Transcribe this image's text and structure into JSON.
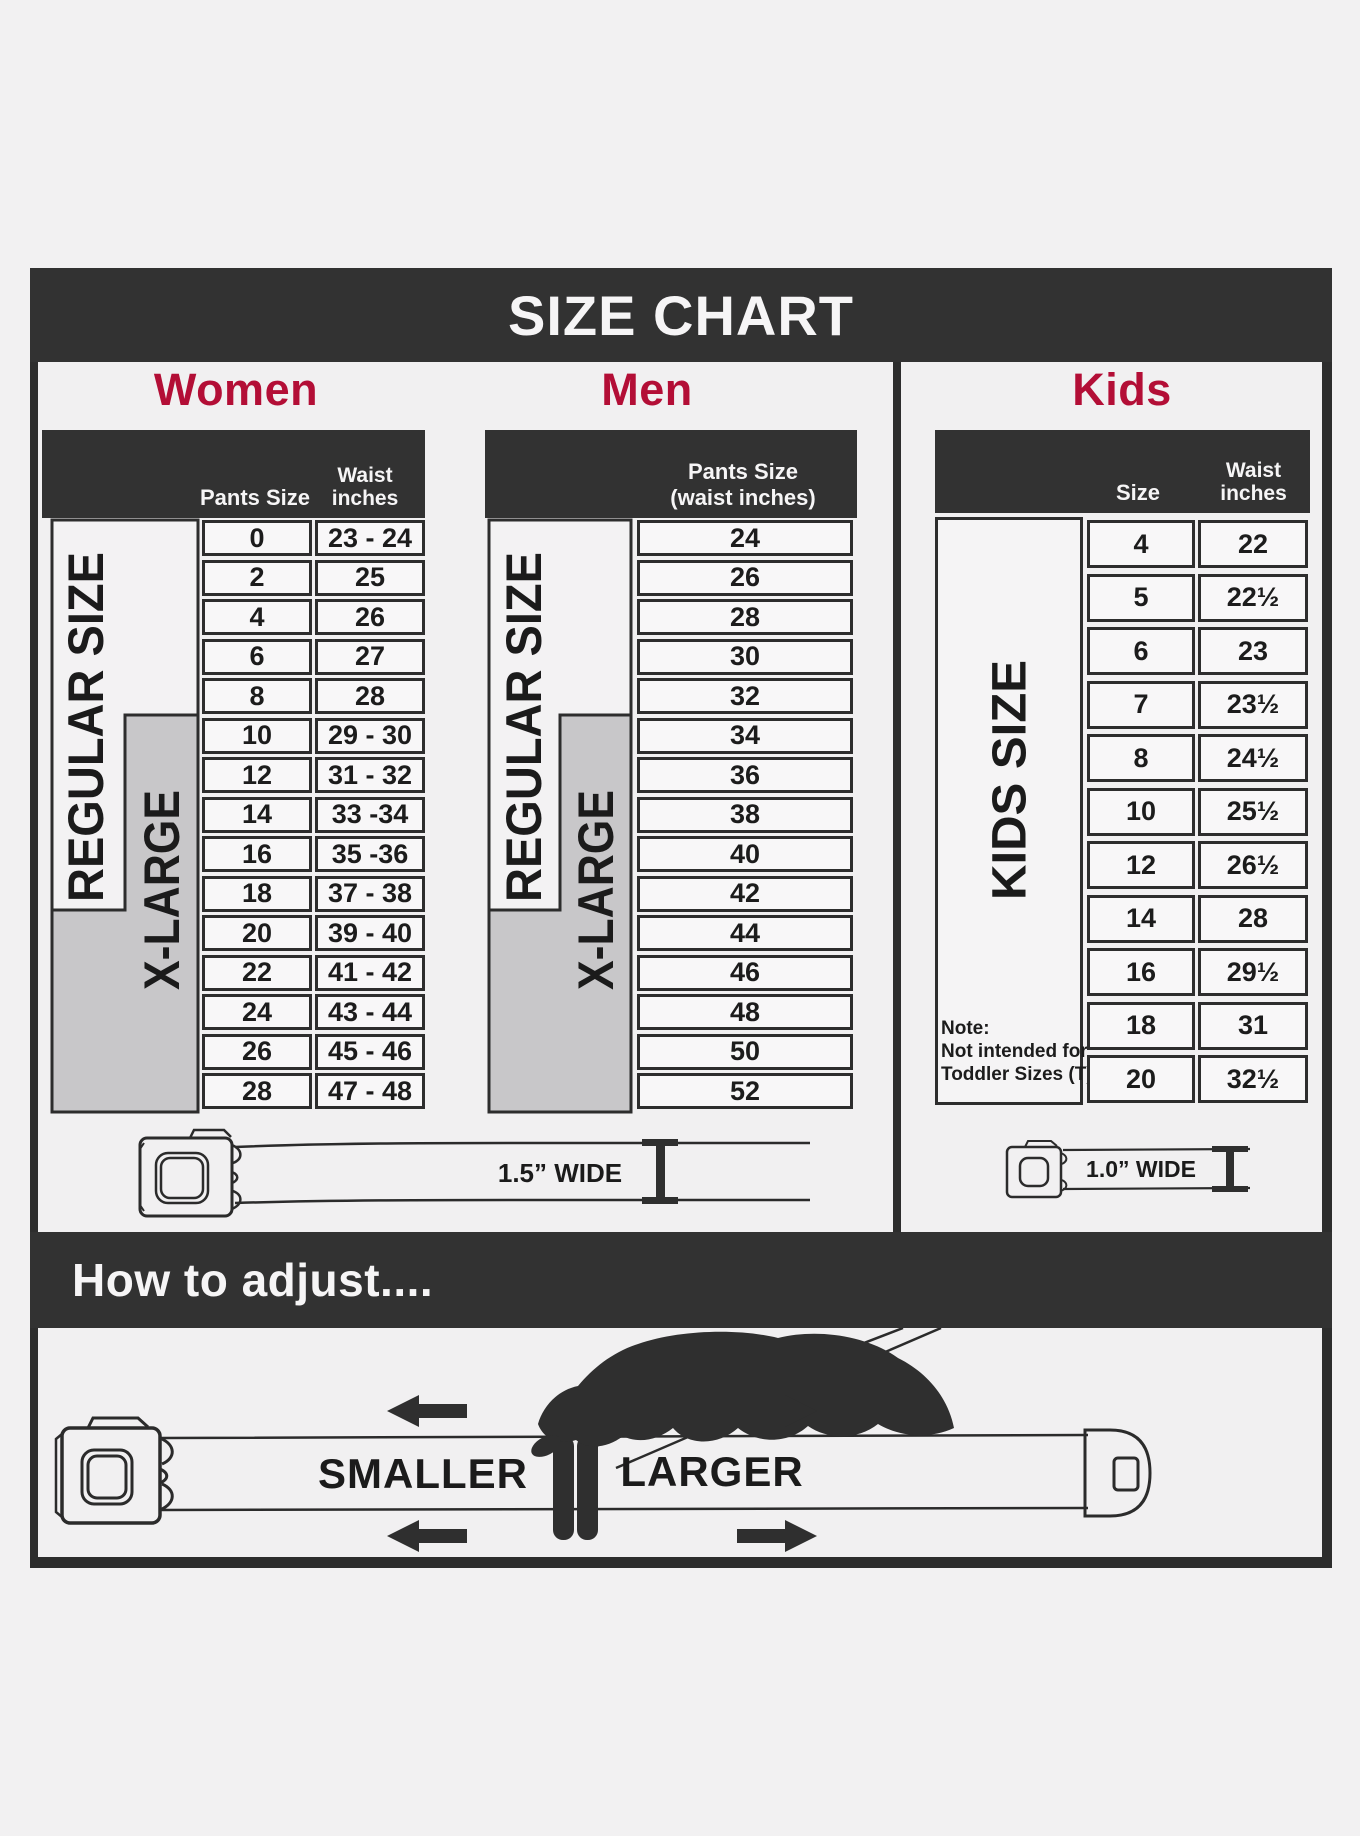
{
  "title": "SIZE CHART",
  "colors": {
    "accent_red": "#b30e36",
    "bar_dark": "#323232",
    "xlarge_gray": "#c8c7c9"
  },
  "women": {
    "heading": "Women",
    "col1_header": "Pants Size",
    "col2_header_line1": "Waist",
    "col2_header_line2": "inches",
    "label_regular": "REGULAR SIZE",
    "label_xlarge": "X-LARGE",
    "rows": [
      {
        "size": "0",
        "waist": "23 - 24"
      },
      {
        "size": "2",
        "waist": "25"
      },
      {
        "size": "4",
        "waist": "26"
      },
      {
        "size": "6",
        "waist": "27"
      },
      {
        "size": "8",
        "waist": "28"
      },
      {
        "size": "10",
        "waist": "29 - 30"
      },
      {
        "size": "12",
        "waist": "31 - 32"
      },
      {
        "size": "14",
        "waist": "33 -34"
      },
      {
        "size": "16",
        "waist": "35 -36"
      },
      {
        "size": "18",
        "waist": "37 - 38"
      },
      {
        "size": "20",
        "waist": "39 - 40"
      },
      {
        "size": "22",
        "waist": "41 - 42"
      },
      {
        "size": "24",
        "waist": "43 - 44"
      },
      {
        "size": "26",
        "waist": "45 - 46"
      },
      {
        "size": "28",
        "waist": "47 - 48"
      }
    ]
  },
  "men": {
    "heading": "Men",
    "col_header_line1": "Pants Size",
    "col_header_line2": "(waist inches)",
    "label_regular": "REGULAR SIZE",
    "label_xlarge": "X-LARGE",
    "rows": [
      "24",
      "26",
      "28",
      "30",
      "32",
      "34",
      "36",
      "38",
      "40",
      "42",
      "44",
      "46",
      "48",
      "50",
      "52"
    ]
  },
  "kids": {
    "heading": "Kids",
    "col1_header": "Size",
    "col2_header_line1": "Waist",
    "col2_header_line2": "inches",
    "label": "KIDS SIZE",
    "note_line1": "Note:",
    "note_line2": "Not intended for",
    "note_line3": "Toddler Sizes (T)",
    "rows": [
      {
        "size": "4",
        "waist": "22"
      },
      {
        "size": "5",
        "waist": "22½"
      },
      {
        "size": "6",
        "waist": "23"
      },
      {
        "size": "7",
        "waist": "23½"
      },
      {
        "size": "8",
        "waist": "24½"
      },
      {
        "size": "10",
        "waist": "25½"
      },
      {
        "size": "12",
        "waist": "26½"
      },
      {
        "size": "14",
        "waist": "28"
      },
      {
        "size": "16",
        "waist": "29½"
      },
      {
        "size": "18",
        "waist": "31"
      },
      {
        "size": "20",
        "waist": "32½"
      }
    ]
  },
  "belts": {
    "adult_width_label": "1.5” WIDE",
    "kids_width_label": "1.0” WIDE"
  },
  "howto": {
    "heading": "How to adjust....",
    "smaller_label": "SMALLER",
    "larger_label": "LARGER"
  }
}
